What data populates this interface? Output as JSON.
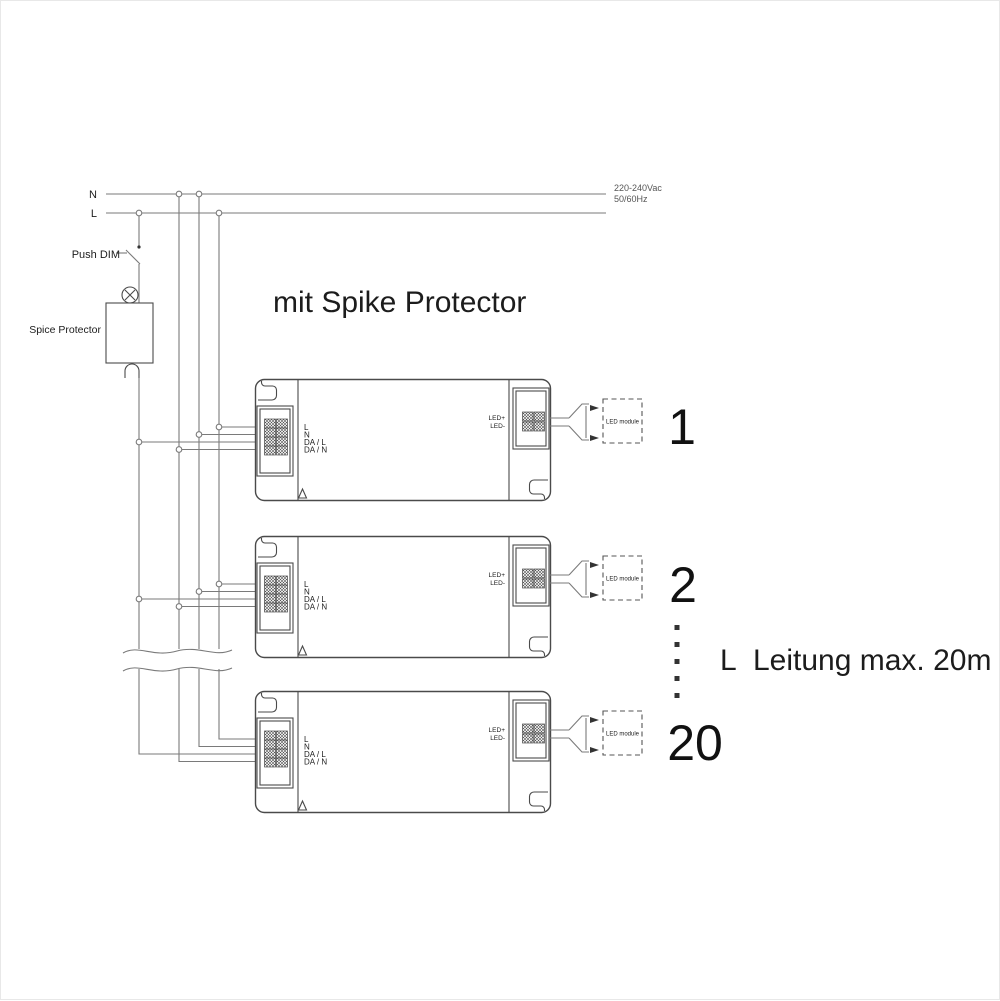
{
  "title": "mit Spike Protector",
  "supply": {
    "n_label": "N",
    "l_label": "L",
    "voltage": "220-240Vac",
    "frequency": "50/60Hz"
  },
  "push_dim_label": "Push DIM",
  "spike_protector_label": "Spice Protector",
  "cable_note": {
    "prefix": "L",
    "text": "Leitung max. 20m"
  },
  "drivers": [
    {
      "index": "1",
      "terminals": [
        "L",
        "N",
        "DA / L",
        "DA / N"
      ],
      "outputs": [
        "LED+",
        "LED-"
      ],
      "module_label": "LED module"
    },
    {
      "index": "2",
      "terminals": [
        "L",
        "N",
        "DA / L",
        "DA / N"
      ],
      "outputs": [
        "LED+",
        "LED-"
      ],
      "module_label": "LED module"
    },
    {
      "index": "20",
      "terminals": [
        "L",
        "N",
        "DA / L",
        "DA / N"
      ],
      "outputs": [
        "LED+",
        "LED-"
      ],
      "module_label": "LED module"
    }
  ],
  "colors": {
    "wire": "#7a7a7a",
    "outline": "#4a4a4a",
    "text": "#1c1c1c"
  }
}
